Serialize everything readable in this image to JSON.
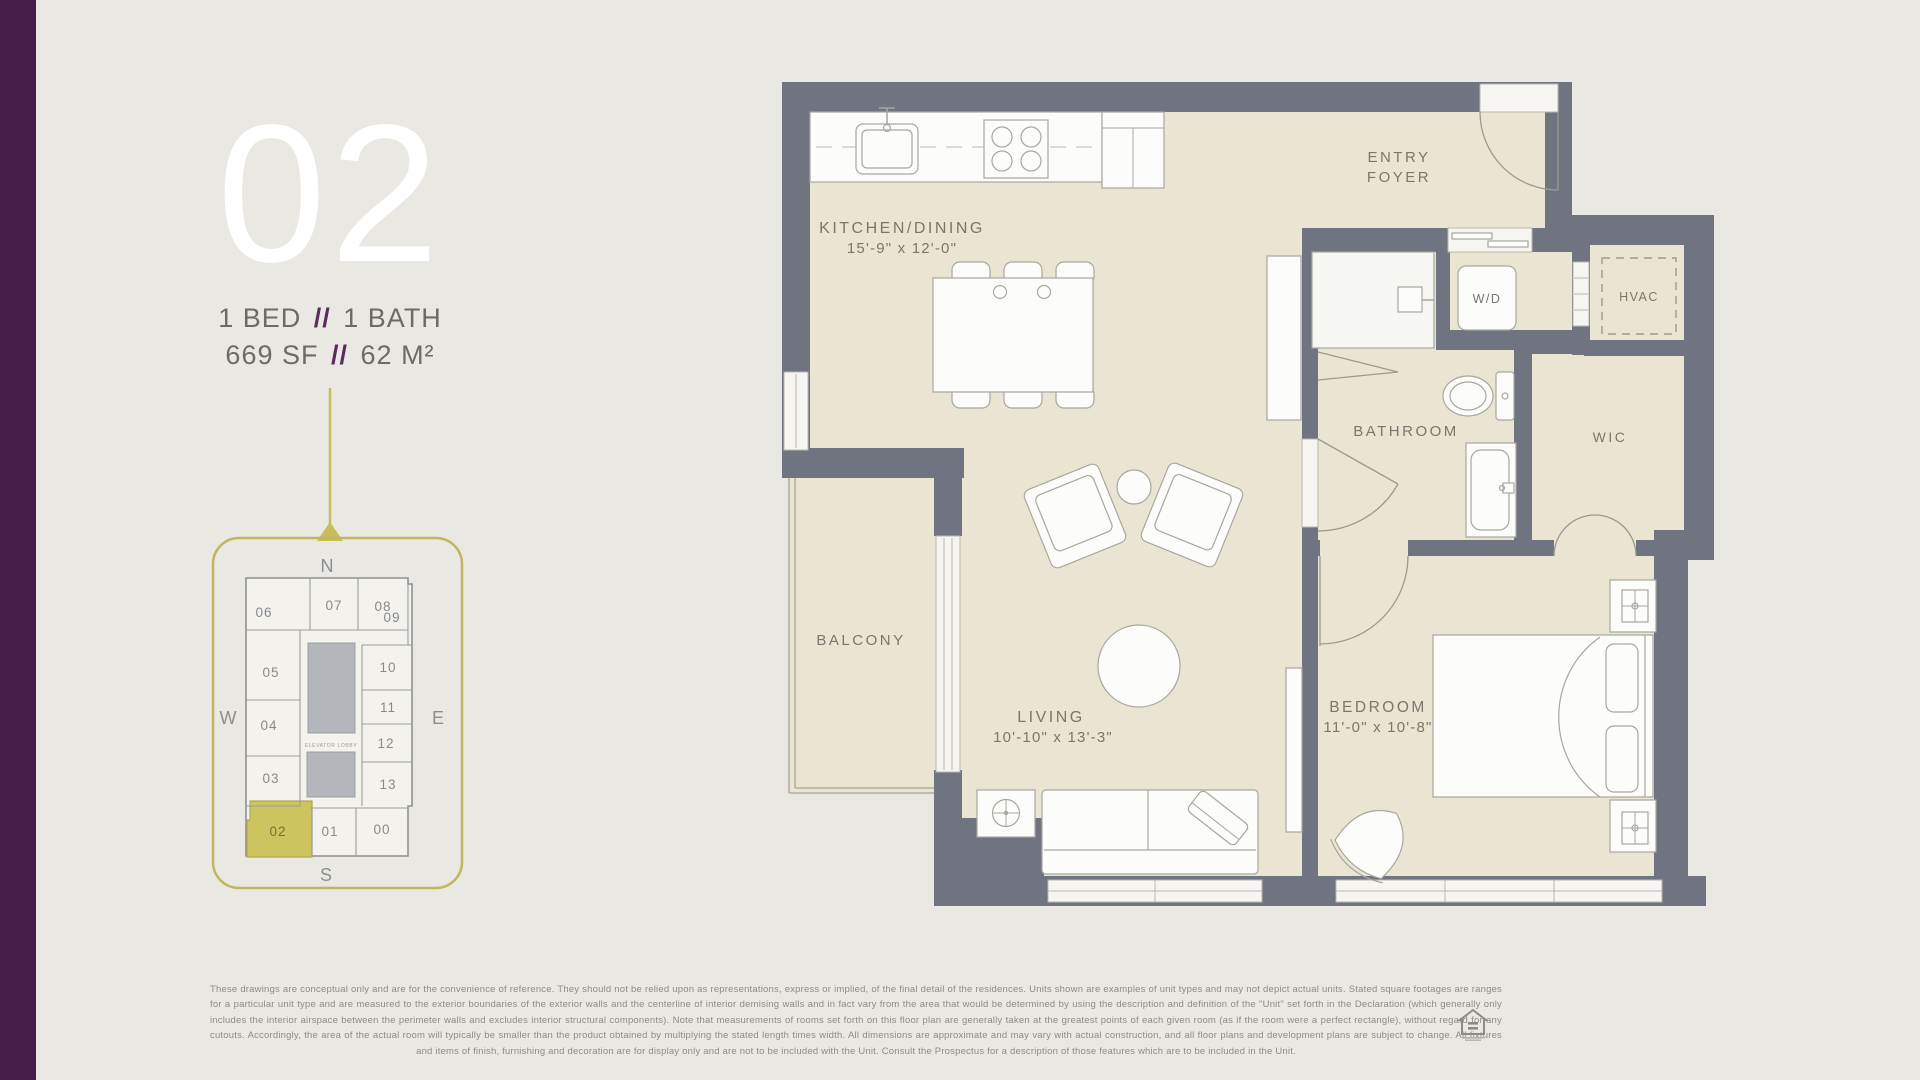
{
  "unit": {
    "number": "02",
    "bed": "1 BED",
    "separator": "//",
    "bath": "1 BATH",
    "area_sf": "669 SF",
    "area_m2": "62 M²"
  },
  "keyplan": {
    "compass": {
      "n": "N",
      "e": "E",
      "s": "S",
      "w": "W"
    },
    "core_label": "ELEVATOR LOBBY",
    "highlighted": "02",
    "units": {
      "u00": "00",
      "u01": "01",
      "u02": "02",
      "u03": "03",
      "u04": "04",
      "u05": "05",
      "u06": "06",
      "u07": "07",
      "u08": "08",
      "u09": "09",
      "u10": "10",
      "u11": "11",
      "u12": "12",
      "u13": "13"
    }
  },
  "rooms": {
    "kitchen": {
      "name": "KITCHEN/DINING",
      "dims": "15'-9\" x 12'-0\""
    },
    "entry": {
      "line1": "ENTRY",
      "line2": "FOYER"
    },
    "wd": {
      "name": "W/D"
    },
    "hvac": {
      "name": "HVAC"
    },
    "bathroom": {
      "name": "BATHROOM"
    },
    "wic": {
      "name": "WIC"
    },
    "balcony": {
      "name": "BALCONY"
    },
    "living": {
      "name": "LIVING",
      "dims": "10'-10\" x 13'-3\""
    },
    "bedroom": {
      "name": "BEDROOM",
      "dims": "11'-0\" x 10'-8\""
    }
  },
  "disclaimer": "These drawings are conceptual only and are for the convenience of reference. They should not be relied upon as representations, express or implied, of the final detail of the residences. Units shown are examples of unit types and may not depict actual units. Stated square footages are ranges for a particular unit type and are measured to the exterior boundaries of the exterior walls and the centerline of interior demising walls and in fact vary from the area that would be determined by using the description and definition of the \"Unit\" set forth in the Declaration (which generally only includes the interior airspace between the perimeter walls and excludes interior structural components). Note that measurements of rooms set forth on this floor plan are generally taken at the greatest points of each given room (as if the room were a perfect rectangle), without regard for any cutouts. Accordingly, the area of the actual room will typically be smaller than the product obtained by multiplying the stated length times width. All dimensions are approximate and may vary with actual construction, and all floor plans and development plans are subject to change. All fixtures and items of finish, furnishing and decoration are for display only and are not to be included with the Unit. Consult the Prospectus for a description of those features which are to be included in the Unit.",
  "colors": {
    "accent_purple": "#471d4a",
    "accent_gold": "#c8bd58",
    "wall_gray": "#6f7480",
    "floor_beige": "#eae5d2"
  }
}
